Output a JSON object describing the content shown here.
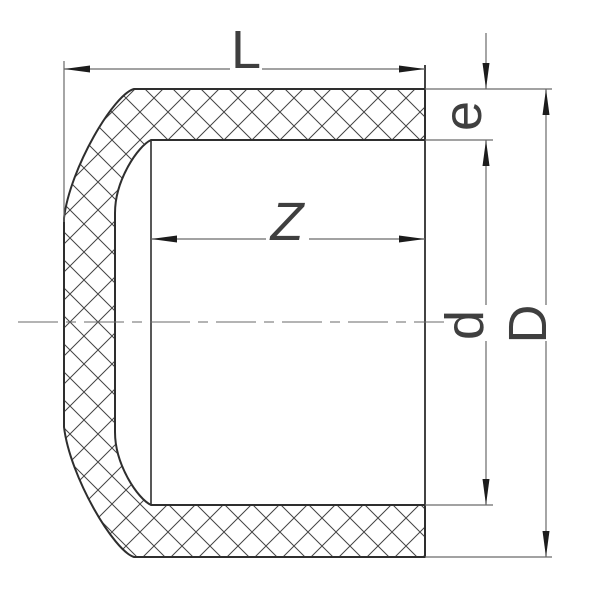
{
  "drawing": {
    "kind": "pipe-end-cap-cross-section",
    "dimension_labels": {
      "overall_length": "L",
      "socket_depth": "Z",
      "wall_thickness": "e",
      "inner_diameter": "d",
      "outer_diameter": "D"
    },
    "colors": {
      "background": "#ffffff",
      "outline": "#2e2e2e",
      "hatch": "#444444",
      "dimension_line": "#6a6a6a",
      "arrow": "#1c1c1c",
      "label": "#3f3f3f",
      "centerline": "#6a6a6a"
    }
  }
}
